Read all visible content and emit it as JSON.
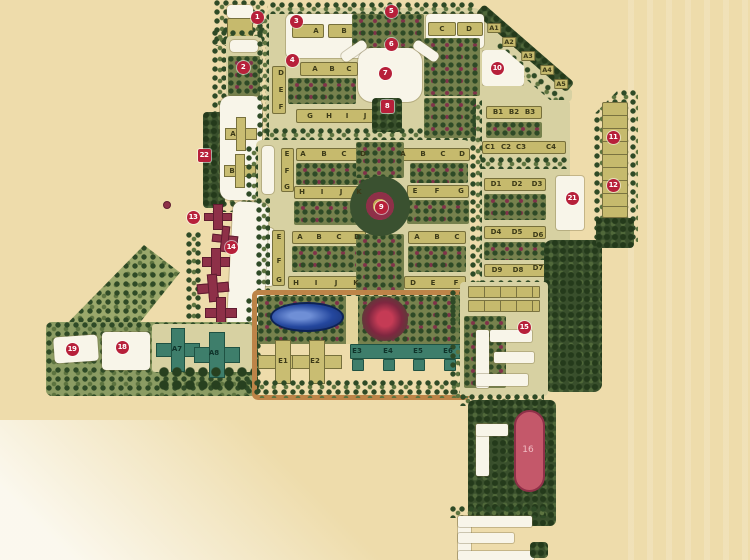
{
  "document": {
    "kind": "scanned residential master plan"
  },
  "palette": {
    "paper": "#eedcab",
    "block_ground": "#d7d1a2",
    "building_tan": "#c6ba6d",
    "building_white": "#f8f5e9",
    "building_teal": "#3e7e6b",
    "building_maroon": "#8e3048",
    "building_capsule_red": "#c4586a",
    "trees_dark_green": "#2e4a26",
    "pond_blue": "#24479e",
    "marker_red": "#b7203a",
    "road_orange": "#bd8448"
  },
  "map": {
    "markers": [
      {
        "n": "1",
        "x": 257,
        "y": 17
      },
      {
        "n": "2",
        "x": 243,
        "y": 67
      },
      {
        "n": "3",
        "x": 296,
        "y": 21
      },
      {
        "n": "4",
        "x": 292,
        "y": 60
      },
      {
        "n": "5",
        "x": 391,
        "y": 11
      },
      {
        "n": "6",
        "x": 391,
        "y": 44
      },
      {
        "n": "7",
        "x": 385,
        "y": 73
      },
      {
        "n": "8",
        "x": 387,
        "y": 106,
        "shape": "square"
      },
      {
        "n": "9",
        "x": 381,
        "y": 207
      },
      {
        "n": "10",
        "x": 497,
        "y": 68
      },
      {
        "n": "11",
        "x": 613,
        "y": 137
      },
      {
        "n": "12",
        "x": 613,
        "y": 185
      },
      {
        "n": "13",
        "x": 193,
        "y": 217
      },
      {
        "n": "14",
        "x": 231,
        "y": 247
      },
      {
        "n": "15",
        "x": 524,
        "y": 327
      },
      {
        "n": "18",
        "x": 122,
        "y": 347
      },
      {
        "n": "19",
        "x": 72,
        "y": 349
      },
      {
        "n": "21",
        "x": 572,
        "y": 198
      },
      {
        "n": "22",
        "x": 204,
        "y": 155,
        "shape": "square"
      }
    ],
    "labels": [
      {
        "t": "A",
        "x": 316,
        "y": 31
      },
      {
        "t": "B",
        "x": 344,
        "y": 31
      },
      {
        "t": "C",
        "x": 442,
        "y": 29
      },
      {
        "t": "D",
        "x": 469,
        "y": 29
      },
      {
        "t": "A",
        "x": 315,
        "y": 69
      },
      {
        "t": "B",
        "x": 332,
        "y": 69
      },
      {
        "t": "C",
        "x": 349,
        "y": 69
      },
      {
        "t": "D",
        "x": 281,
        "y": 73
      },
      {
        "t": "E",
        "x": 281,
        "y": 90
      },
      {
        "t": "F",
        "x": 281,
        "y": 107
      },
      {
        "t": "G",
        "x": 310,
        "y": 116
      },
      {
        "t": "H",
        "x": 329,
        "y": 116
      },
      {
        "t": "I",
        "x": 347,
        "y": 116
      },
      {
        "t": "J",
        "x": 365,
        "y": 116
      },
      {
        "t": "A1",
        "x": 494,
        "y": 28,
        "s": "chip"
      },
      {
        "t": "A2",
        "x": 509,
        "y": 42,
        "s": "chip"
      },
      {
        "t": "A3",
        "x": 528,
        "y": 56,
        "s": "chip"
      },
      {
        "t": "A4",
        "x": 547,
        "y": 70,
        "s": "chip"
      },
      {
        "t": "A5",
        "x": 561,
        "y": 84,
        "s": "chip"
      },
      {
        "t": "B1",
        "x": 498,
        "y": 112
      },
      {
        "t": "B2",
        "x": 514,
        "y": 112
      },
      {
        "t": "B3",
        "x": 530,
        "y": 112
      },
      {
        "t": "C1",
        "x": 490,
        "y": 147
      },
      {
        "t": "C2",
        "x": 506,
        "y": 147
      },
      {
        "t": "C3",
        "x": 521,
        "y": 147
      },
      {
        "t": "C4",
        "x": 551,
        "y": 147
      },
      {
        "t": "D1",
        "x": 496,
        "y": 184
      },
      {
        "t": "D2",
        "x": 517,
        "y": 184
      },
      {
        "t": "D3",
        "x": 537,
        "y": 184
      },
      {
        "t": "D4",
        "x": 496,
        "y": 232
      },
      {
        "t": "D5",
        "x": 517,
        "y": 232
      },
      {
        "t": "D6",
        "x": 538,
        "y": 235
      },
      {
        "t": "D9",
        "x": 497,
        "y": 270
      },
      {
        "t": "D8",
        "x": 518,
        "y": 270
      },
      {
        "t": "D7",
        "x": 538,
        "y": 268
      },
      {
        "t": "E",
        "x": 287,
        "y": 154
      },
      {
        "t": "F",
        "x": 287,
        "y": 171
      },
      {
        "t": "G",
        "x": 287,
        "y": 187
      },
      {
        "t": "A",
        "x": 303,
        "y": 154
      },
      {
        "t": "B",
        "x": 324,
        "y": 154
      },
      {
        "t": "C",
        "x": 344,
        "y": 154
      },
      {
        "t": "D",
        "x": 363,
        "y": 154
      },
      {
        "t": "H",
        "x": 302,
        "y": 192
      },
      {
        "t": "I",
        "x": 322,
        "y": 192
      },
      {
        "t": "J",
        "x": 341,
        "y": 192
      },
      {
        "t": "K",
        "x": 359,
        "y": 192
      },
      {
        "t": "A",
        "x": 403,
        "y": 154
      },
      {
        "t": "B",
        "x": 423,
        "y": 154
      },
      {
        "t": "C",
        "x": 443,
        "y": 154
      },
      {
        "t": "D",
        "x": 462,
        "y": 154
      },
      {
        "t": "E",
        "x": 415,
        "y": 191
      },
      {
        "t": "F",
        "x": 437,
        "y": 191
      },
      {
        "t": "G",
        "x": 461,
        "y": 191
      },
      {
        "t": "E",
        "x": 279,
        "y": 237
      },
      {
        "t": "F",
        "x": 279,
        "y": 261
      },
      {
        "t": "G",
        "x": 279,
        "y": 280
      },
      {
        "t": "A",
        "x": 300,
        "y": 237
      },
      {
        "t": "B",
        "x": 319,
        "y": 237
      },
      {
        "t": "C",
        "x": 339,
        "y": 237
      },
      {
        "t": "D",
        "x": 357,
        "y": 237
      },
      {
        "t": "H",
        "x": 296,
        "y": 283
      },
      {
        "t": "I",
        "x": 316,
        "y": 283
      },
      {
        "t": "J",
        "x": 336,
        "y": 283
      },
      {
        "t": "K",
        "x": 356,
        "y": 283
      },
      {
        "t": "A",
        "x": 417,
        "y": 237
      },
      {
        "t": "B",
        "x": 437,
        "y": 237
      },
      {
        "t": "C",
        "x": 457,
        "y": 237
      },
      {
        "t": "D",
        "x": 413,
        "y": 283
      },
      {
        "t": "E",
        "x": 433,
        "y": 283
      },
      {
        "t": "F",
        "x": 456,
        "y": 283
      },
      {
        "t": "A",
        "x": 233,
        "y": 134
      },
      {
        "t": "B",
        "x": 232,
        "y": 171
      },
      {
        "t": "E1",
        "x": 283,
        "y": 361
      },
      {
        "t": "E2",
        "x": 315,
        "y": 361
      },
      {
        "t": "E3",
        "x": 357,
        "y": 351,
        "s": "teal-label"
      },
      {
        "t": "E4",
        "x": 388,
        "y": 351,
        "s": "teal-label"
      },
      {
        "t": "E5",
        "x": 418,
        "y": 351,
        "s": "teal-label"
      },
      {
        "t": "E6",
        "x": 448,
        "y": 351,
        "s": "teal-label"
      },
      {
        "t": "A7",
        "x": 177,
        "y": 349,
        "s": "teal-label"
      },
      {
        "t": "A8",
        "x": 214,
        "y": 353,
        "s": "teal-label"
      },
      {
        "t": "16",
        "x": 528,
        "y": 450,
        "s": "capsule-label"
      }
    ]
  }
}
